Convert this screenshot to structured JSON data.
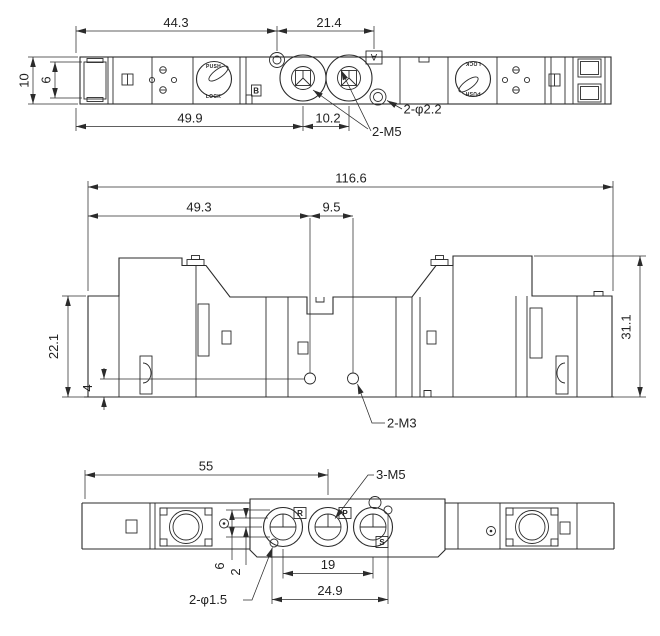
{
  "colors": {
    "line": "#2b2b2b",
    "background": "#ffffff"
  },
  "top_view": {
    "dims": {
      "width_overall": "44.3",
      "width_right": "21.4",
      "height": "10",
      "height_inner": "6",
      "bottom_left": "49.9",
      "port_spacing": "10.2"
    },
    "labels": {
      "mount_holes": "2-φ2.2",
      "ports": "2-M5",
      "port_a": "A",
      "port_b": "B",
      "knob_push": "PUSH",
      "knob_lock": "LOCK"
    }
  },
  "front_view": {
    "dims": {
      "width_overall": "116.6",
      "width_left": "49.3",
      "width_center": "9.5",
      "height_left": "22.1",
      "height_base": "4",
      "height_right": "31.1"
    },
    "labels": {
      "screw_holes": "2-M3"
    }
  },
  "bottom_view": {
    "dims": {
      "width_left": "55",
      "port_span": "19",
      "hole_span": "24.9",
      "offset_a": "6",
      "offset_b": "2"
    },
    "labels": {
      "ports": "3-M5",
      "pin_holes": "2-φ1.5",
      "port_r": "R",
      "port_p": "P",
      "port_s": "S"
    }
  }
}
